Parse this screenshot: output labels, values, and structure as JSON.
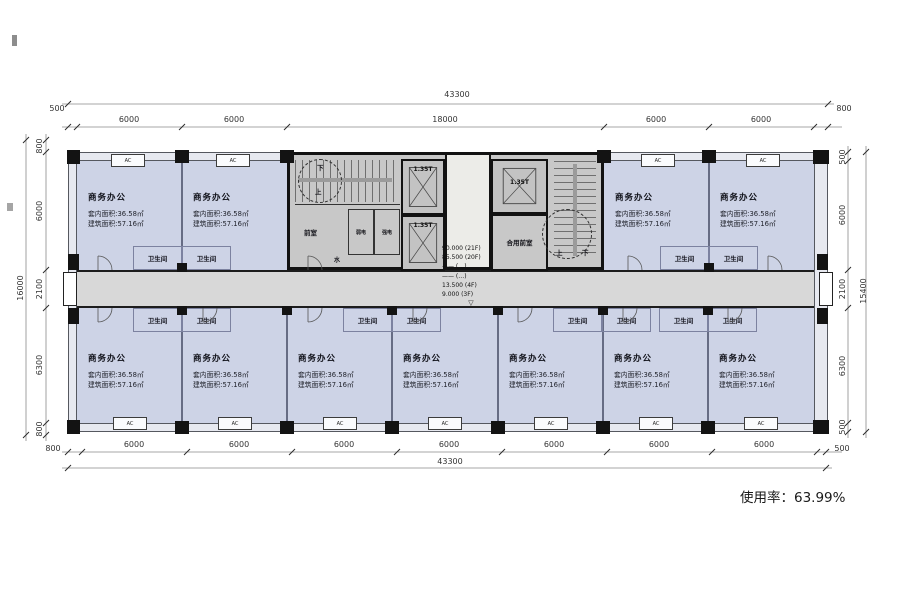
{
  "plan": {
    "usage_rate": "使用率：63.99%",
    "office": {
      "name": "商务办公",
      "inner_area": "套内面积:36.58㎡",
      "gross_area": "建筑面积:57.16㎡"
    },
    "toilet": "卫生间",
    "ac": "AC",
    "core": {
      "front_room": "前室",
      "weak_electric": "弱电",
      "strong_electric": "强电",
      "water": "水",
      "elevator": "1.35T",
      "shared_front_room": "合用前室",
      "stair_up": "上",
      "stair_down": "下",
      "levels": [
        "90.000 (21F)",
        "85.500 (20F)",
        "—— (…)",
        "—— (…)",
        "13.500 (4F)",
        "9.000 (3F)"
      ],
      "level_marker": "▽"
    },
    "dims": {
      "top_overall": "43300",
      "top_segments": [
        "500",
        "6000",
        "6000",
        "18000",
        "6000",
        "6000",
        "800"
      ],
      "bottom_overall": "43300",
      "bottom_segments": [
        "800",
        "6000",
        "6000",
        "6000",
        "6000",
        "6000",
        "6000",
        "6000",
        "500"
      ],
      "left_overall": "16000",
      "left_segments": [
        "800",
        "6000",
        "2100",
        "6300",
        "800"
      ],
      "right_overall": "15400",
      "right_segments": [
        "500",
        "6000",
        "2100",
        "6300",
        "500"
      ],
      "corridor_width": "1600"
    },
    "colors": {
      "room": "#cdd3e6",
      "corridor": "#d8d8d8",
      "core": "#c8c8c8",
      "wall": "#131313"
    }
  }
}
